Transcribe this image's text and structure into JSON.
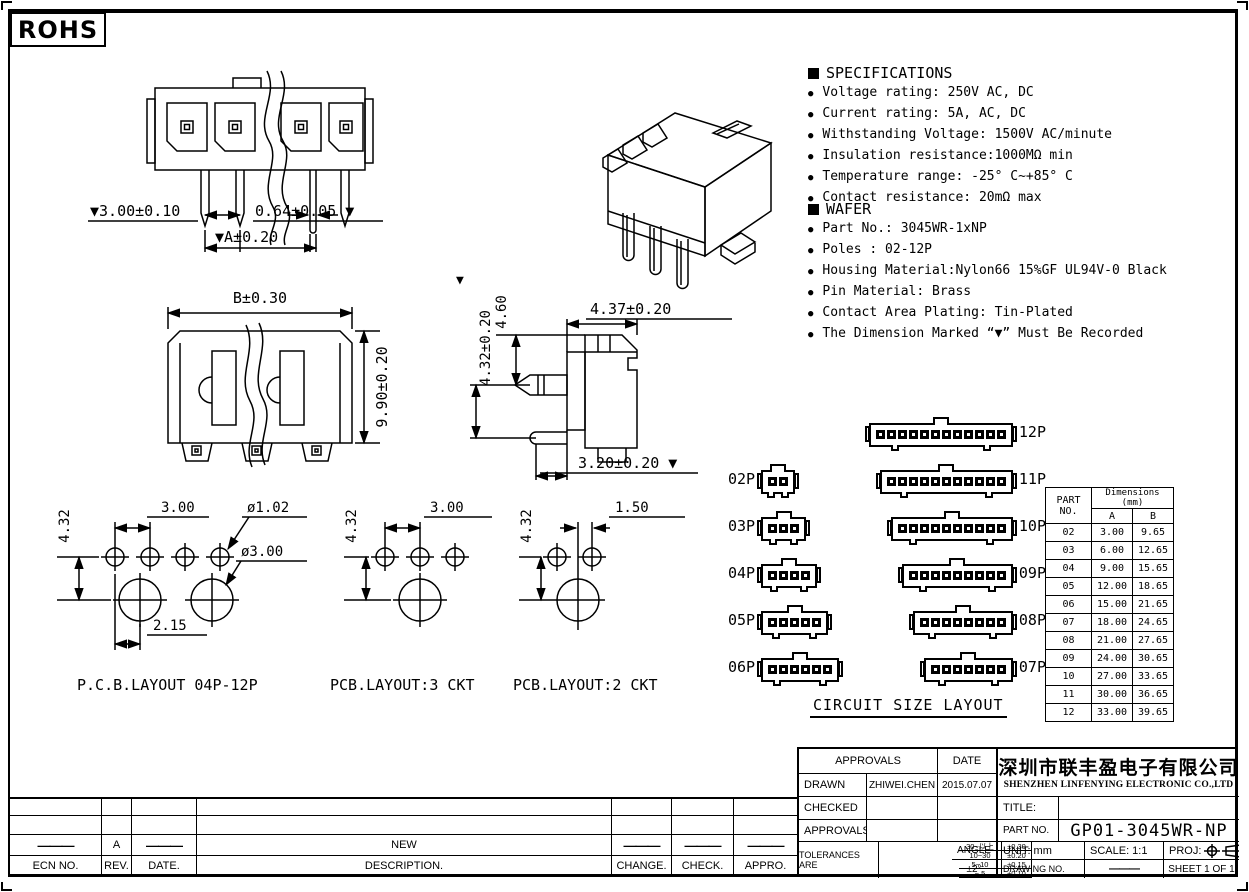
{
  "colors": {
    "ink": "#000000",
    "paper": "#ffffff"
  },
  "rohs": "ROHS",
  "specifications": {
    "title": "SPECIFICATIONS",
    "items": [
      "Voltage rating: 250V AC, DC",
      "Current rating: 5A, AC, DC",
      "Withstanding Voltage: 1500V AC/minute",
      "Insulation resistance:1000MΩ min",
      "Temperature range: -25° C~+85° C",
      "Contact resistance: 20mΩ max"
    ]
  },
  "wafer": {
    "title": "WAFER",
    "items": [
      "Part No.: 3045WR-1xNP",
      "Poles : 02-12P",
      "Housing Material:Nylon66 15%GF UL94V-0 Black",
      "Pin Material: Brass",
      "Contact Area Plating: Tin-Plated",
      "The Dimension Marked “▼” Must Be Recorded"
    ]
  },
  "drawings": {
    "front_view": {
      "pitch": "▼3.00±0.10",
      "pin_width": "0.64±0.05 ▼",
      "overall_a": "▼A±0.20"
    },
    "housing_view": {
      "width_b": "B±0.30",
      "height": "9.90±0.20"
    },
    "side_view": {
      "tri": "▼",
      "height_432": "4.32±0.20",
      "height_460": "4.60",
      "depth": "4.37±0.20",
      "bottom": "3.20±0.20 ▼"
    },
    "pcb_main": {
      "v": "4.32",
      "pitch": "3.00",
      "hole_small": "ø1.02",
      "hole_big": "ø3.00",
      "offset": "2.15",
      "caption": "P.C.B.LAYOUT 04P-12P"
    },
    "pcb_3ckt": {
      "v": "4.32",
      "pitch": "3.00",
      "caption": "PCB.LAYOUT:3 CKT"
    },
    "pcb_2ckt": {
      "v": "4.32",
      "pitch": "1.50",
      "caption": "PCB.LAYOUT:2 CKT"
    }
  },
  "circuit_layout": {
    "title": "CIRCUIT SIZE LAYOUT",
    "rows": [
      {
        "right": {
          "label": "12P",
          "pins": 12
        }
      },
      {
        "left": {
          "label": "02P",
          "pins": 2
        },
        "right": {
          "label": "11P",
          "pins": 11
        }
      },
      {
        "left": {
          "label": "03P",
          "pins": 3
        },
        "right": {
          "label": "10P",
          "pins": 10
        }
      },
      {
        "left": {
          "label": "04P",
          "pins": 4
        },
        "right": {
          "label": "09P",
          "pins": 9
        }
      },
      {
        "left": {
          "label": "05P",
          "pins": 5
        },
        "right": {
          "label": "08P",
          "pins": 8
        }
      },
      {
        "left": {
          "label": "06P",
          "pins": 6
        },
        "right": {
          "label": "07P",
          "pins": 7
        }
      }
    ]
  },
  "size_table": {
    "part_header": "PART NO.",
    "dims_header": "Dimensions (mm)",
    "col_a": "A",
    "col_b": "B",
    "rows": [
      [
        "02",
        "3.00",
        "9.65"
      ],
      [
        "03",
        "6.00",
        "12.65"
      ],
      [
        "04",
        "9.00",
        "15.65"
      ],
      [
        "05",
        "12.00",
        "18.65"
      ],
      [
        "06",
        "15.00",
        "21.65"
      ],
      [
        "07",
        "18.00",
        "24.65"
      ],
      [
        "08",
        "21.00",
        "27.65"
      ],
      [
        "09",
        "24.00",
        "30.65"
      ],
      [
        "10",
        "27.00",
        "33.65"
      ],
      [
        "11",
        "30.00",
        "36.65"
      ],
      [
        "12",
        "33.00",
        "39.65"
      ]
    ]
  },
  "revision_table": {
    "headers": [
      "ECN NO.",
      "REV.",
      "DATE.",
      "DESCRIPTION.",
      "CHANGE.",
      "CHECK.",
      "APPRO."
    ],
    "rows": [
      [
        "",
        "",
        "",
        "",
        "",
        "",
        ""
      ],
      [
        "",
        "",
        "",
        "",
        "",
        "",
        ""
      ],
      [
        "———",
        "A",
        "———",
        "NEW",
        "———",
        "———",
        "———"
      ]
    ]
  },
  "title_block": {
    "approvals_header": "APPROVALS",
    "date_header": "DATE",
    "drawn_label": "DRAWN",
    "drawn_by": "ZHIWEI.CHEN",
    "drawn_date": "2015.07.07",
    "checked_label": "CHECKED",
    "approved_label": "APPROVALS",
    "tolerances_label": "TOLERANCES ARE",
    "tolerance_rows": [
      [
        "30~以上",
        "±0.30"
      ],
      [
        "10~30",
        "±0.20"
      ],
      [
        "5~10",
        "±0.15"
      ],
      [
        "~ 5",
        "±0.10"
      ]
    ],
    "angle_label": "ANGLE",
    "angle_value": "±2°",
    "company_cn": "深圳市联丰盈电子有限公司",
    "company_en": "SHENZHEN LINFENYING ELECTRONIC CO.,LTD",
    "title_label": "TITLE:",
    "part_no_label": "PART NO.",
    "part_no": "GP01-3045WR-NP",
    "unit_text": "UNIT: mm",
    "scale_text": "SCALE: 1:1",
    "proj_label": "PROJ:",
    "drawing_no_label": "DRAWING NO.",
    "drawing_no_value": "———",
    "sheet_text": "SHEET 1 OF 1"
  }
}
